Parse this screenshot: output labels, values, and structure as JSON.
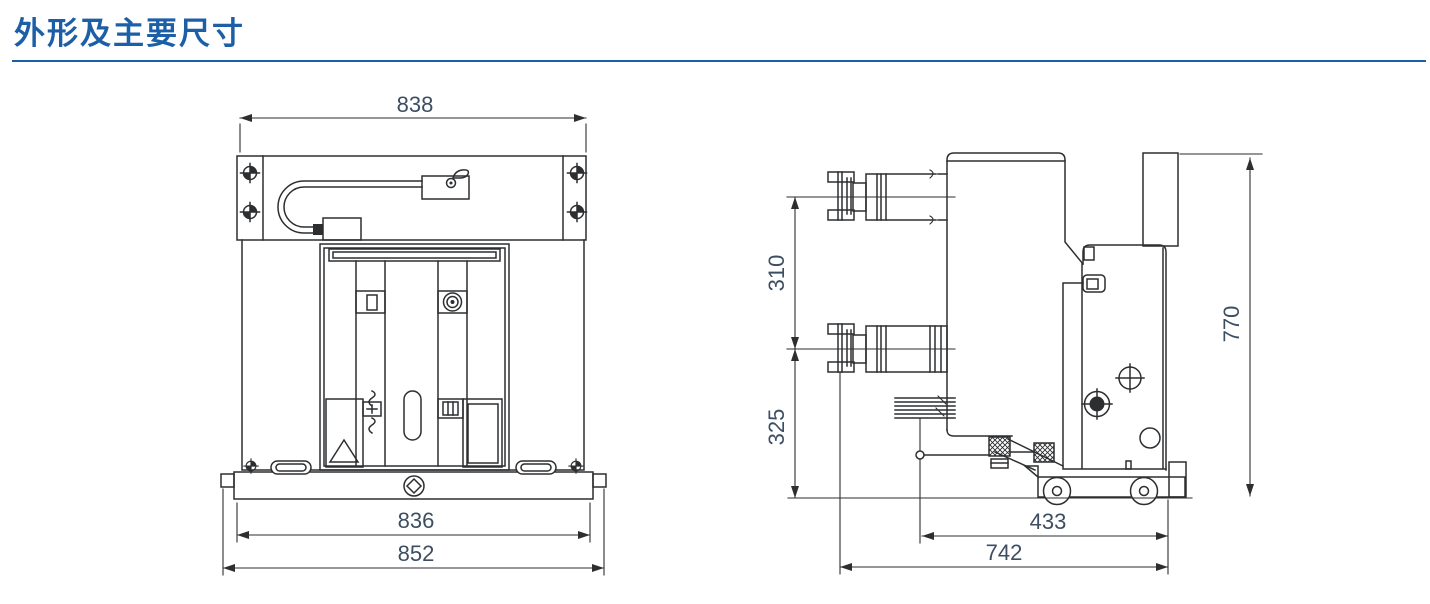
{
  "page": {
    "title": "外形及主要尺寸",
    "accent_color": "#1d5fa7",
    "background_color": "#ffffff",
    "drawing_line_color": "#2c2e30",
    "dimension_text_color": "#3d4e63"
  },
  "front_view": {
    "name": "front view",
    "dimensions": {
      "overall_width_top": "838",
      "frame_width": "836",
      "overall_width_base": "852"
    },
    "symbols": [
      "datum-target-icon",
      "lifting-cable-loop",
      "interlock-slot-icon",
      "concentric-rings-icon",
      "spring-charge-icon",
      "keyhole-slot-icon",
      "latch-window-icon",
      "warning-triangle-icon",
      "diamond-lock-icon",
      "handle-slot-icon"
    ]
  },
  "side_view": {
    "name": "side view",
    "dimensions": {
      "terminal_pitch": "310",
      "lower_terminal_to_base": "325",
      "overall_height": "770",
      "axis_to_rear": "433",
      "overall_depth": "742"
    },
    "symbols": [
      "upper-terminal-bushing",
      "lower-terminal-bushing",
      "flexible-connector",
      "open-target-icon",
      "filled-target-icon",
      "round-hole-icon",
      "hatched-bolt-icon",
      "trolley-wheel-icon",
      "rear-riser-plate"
    ]
  }
}
